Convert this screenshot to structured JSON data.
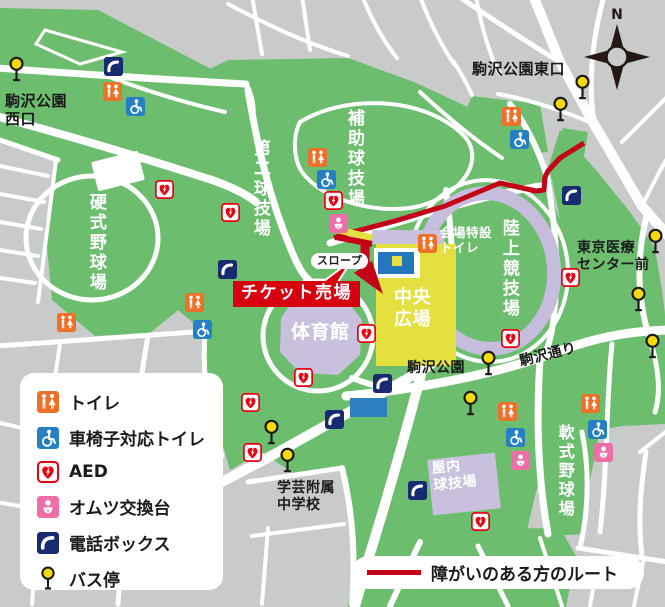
{
  "map": {
    "region_labels": [
      {
        "id": "west-entrance",
        "text": "駒沢公園\n西口",
        "x": 5,
        "y": 92,
        "size": 15
      },
      {
        "id": "east-entrance",
        "text": "駒沢公園東口",
        "x": 472,
        "y": 60,
        "size": 15
      },
      {
        "id": "tokyo-medical-center",
        "text": "東京医療\nセンター前",
        "x": 577,
        "y": 240,
        "size": 14
      },
      {
        "id": "komazawa-park-stop",
        "text": "駒沢公園",
        "x": 407,
        "y": 360,
        "size": 14
      },
      {
        "id": "komazawa-dori",
        "text": "駒沢通り",
        "x": 518,
        "y": 354,
        "size": 14,
        "rotate": -14
      },
      {
        "id": "gakugei-school",
        "text": "学芸附属\n中学校",
        "x": 277,
        "y": 480,
        "size": 14
      },
      {
        "id": "venue-toilet",
        "text": "会場特設\nトイレ",
        "x": 440,
        "y": 225,
        "size": 12.5,
        "color": "#ffffff"
      },
      {
        "id": "slope",
        "text": "スロープ",
        "x": 311,
        "y": 253,
        "size": 11,
        "style": "pill"
      },
      {
        "id": "ticket-office",
        "text": "チケット売場",
        "x": 233,
        "y": 281,
        "size": 17,
        "style": "banner"
      },
      {
        "id": "koshiki-baseball",
        "text": "硬式野球場",
        "x": 86,
        "y": 193,
        "size": 17,
        "color": "#ffffff",
        "vertical": true
      },
      {
        "id": "daini-field",
        "text": "第二球技場",
        "x": 250,
        "y": 139,
        "size": 17,
        "color": "#ffffff",
        "vertical": true
      },
      {
        "id": "hojo-field",
        "text": "補助球技場",
        "x": 344,
        "y": 109,
        "size": 17,
        "color": "#ffffff",
        "vertical": true
      },
      {
        "id": "rikujo-stadium",
        "text": "陸上競技場",
        "x": 499,
        "y": 219,
        "size": 17,
        "color": "#ffffff",
        "vertical": true
      },
      {
        "id": "nanshiki-baseball",
        "text": "軟式野球場",
        "x": 556,
        "y": 424,
        "size": 16,
        "color": "#ffffff",
        "vertical": true
      },
      {
        "id": "gymnasium",
        "text": "体育館",
        "x": 291,
        "y": 321,
        "size": 19,
        "color": "#ffffff"
      },
      {
        "id": "central-plaza",
        "text": "中央\n広場",
        "x": 394,
        "y": 287,
        "size": 18,
        "color": "#ffffff"
      },
      {
        "id": "indoor-ballpark",
        "text": "屋内\n球技場",
        "x": 431,
        "y": 461,
        "size": 14,
        "color": "#ffffff",
        "rotate": -6
      }
    ],
    "markers": [
      {
        "type": "toilet",
        "x": 112,
        "y": 91
      },
      {
        "type": "toilet",
        "x": 317,
        "y": 157
      },
      {
        "type": "toilet",
        "x": 427,
        "y": 243
      },
      {
        "type": "toilet",
        "x": 511,
        "y": 116
      },
      {
        "type": "toilet",
        "x": 66,
        "y": 322
      },
      {
        "type": "toilet",
        "x": 194,
        "y": 302
      },
      {
        "type": "toilet",
        "x": 507,
        "y": 411
      },
      {
        "type": "toilet",
        "x": 590,
        "y": 403
      },
      {
        "type": "wheelchair",
        "x": 135,
        "y": 106
      },
      {
        "type": "wheelchair",
        "x": 326,
        "y": 179
      },
      {
        "type": "wheelchair",
        "x": 519,
        "y": 139
      },
      {
        "type": "wheelchair",
        "x": 202,
        "y": 329
      },
      {
        "type": "wheelchair",
        "x": 515,
        "y": 437
      },
      {
        "type": "wheelchair",
        "x": 597,
        "y": 429
      },
      {
        "type": "aed",
        "x": 164,
        "y": 189
      },
      {
        "type": "aed",
        "x": 230,
        "y": 212
      },
      {
        "type": "aed",
        "x": 333,
        "y": 200
      },
      {
        "type": "aed",
        "x": 570,
        "y": 277
      },
      {
        "type": "aed",
        "x": 510,
        "y": 338
      },
      {
        "type": "aed",
        "x": 366,
        "y": 333
      },
      {
        "type": "aed",
        "x": 303,
        "y": 377
      },
      {
        "type": "aed",
        "x": 250,
        "y": 402
      },
      {
        "type": "aed",
        "x": 252,
        "y": 452
      },
      {
        "type": "aed",
        "x": 480,
        "y": 521
      },
      {
        "type": "diaper",
        "x": 338,
        "y": 223
      },
      {
        "type": "diaper",
        "x": 520,
        "y": 460
      },
      {
        "type": "diaper",
        "x": 603,
        "y": 452
      },
      {
        "type": "phone",
        "x": 113,
        "y": 66
      },
      {
        "type": "phone",
        "x": 227,
        "y": 269
      },
      {
        "type": "phone",
        "x": 571,
        "y": 195
      },
      {
        "type": "phone",
        "x": 382,
        "y": 383
      },
      {
        "type": "phone",
        "x": 334,
        "y": 419
      },
      {
        "type": "phone",
        "x": 417,
        "y": 490
      },
      {
        "type": "bus",
        "x": 16,
        "y": 64
      },
      {
        "type": "bus",
        "x": 582,
        "y": 82
      },
      {
        "type": "bus",
        "x": 560,
        "y": 104
      },
      {
        "type": "bus",
        "x": 655,
        "y": 236
      },
      {
        "type": "bus",
        "x": 638,
        "y": 294
      },
      {
        "type": "bus",
        "x": 652,
        "y": 341
      },
      {
        "type": "bus",
        "x": 488,
        "y": 358
      },
      {
        "type": "bus",
        "x": 470,
        "y": 398
      },
      {
        "type": "bus",
        "x": 271,
        "y": 427
      },
      {
        "type": "bus",
        "x": 287,
        "y": 455
      }
    ]
  },
  "legend": {
    "items": [
      {
        "type": "toilet",
        "label": "トイレ"
      },
      {
        "type": "wheelchair",
        "label": "車椅子対応トイレ"
      },
      {
        "type": "aed",
        "label": "AED"
      },
      {
        "type": "diaper",
        "label": "オムツ交換台"
      },
      {
        "type": "phone",
        "label": "電話ボックス"
      },
      {
        "type": "bus",
        "label": "バス停"
      }
    ]
  },
  "route_legend": {
    "label": "障がいのある方のルート"
  },
  "compass": {
    "label": "N"
  },
  "colors": {
    "park_green": "#6cbd6e",
    "street_gray": "#c9caca",
    "road_white": "#ffffff",
    "building_lavender": "#c9c0de",
    "plaza_yellow": "#e4e040",
    "stage_blue": "#2577bd",
    "route_red": "#c40018",
    "banner_red": "#d7000f",
    "toilet_orange": "#ed7128",
    "wheelchair_blue": "#2580c3",
    "aed_red": "#e60012",
    "diaper_pink": "#ed6fa5",
    "phone_navy": "#182a70",
    "bus_yellow": "#f7d908",
    "text_black": "#1a1a1a"
  }
}
